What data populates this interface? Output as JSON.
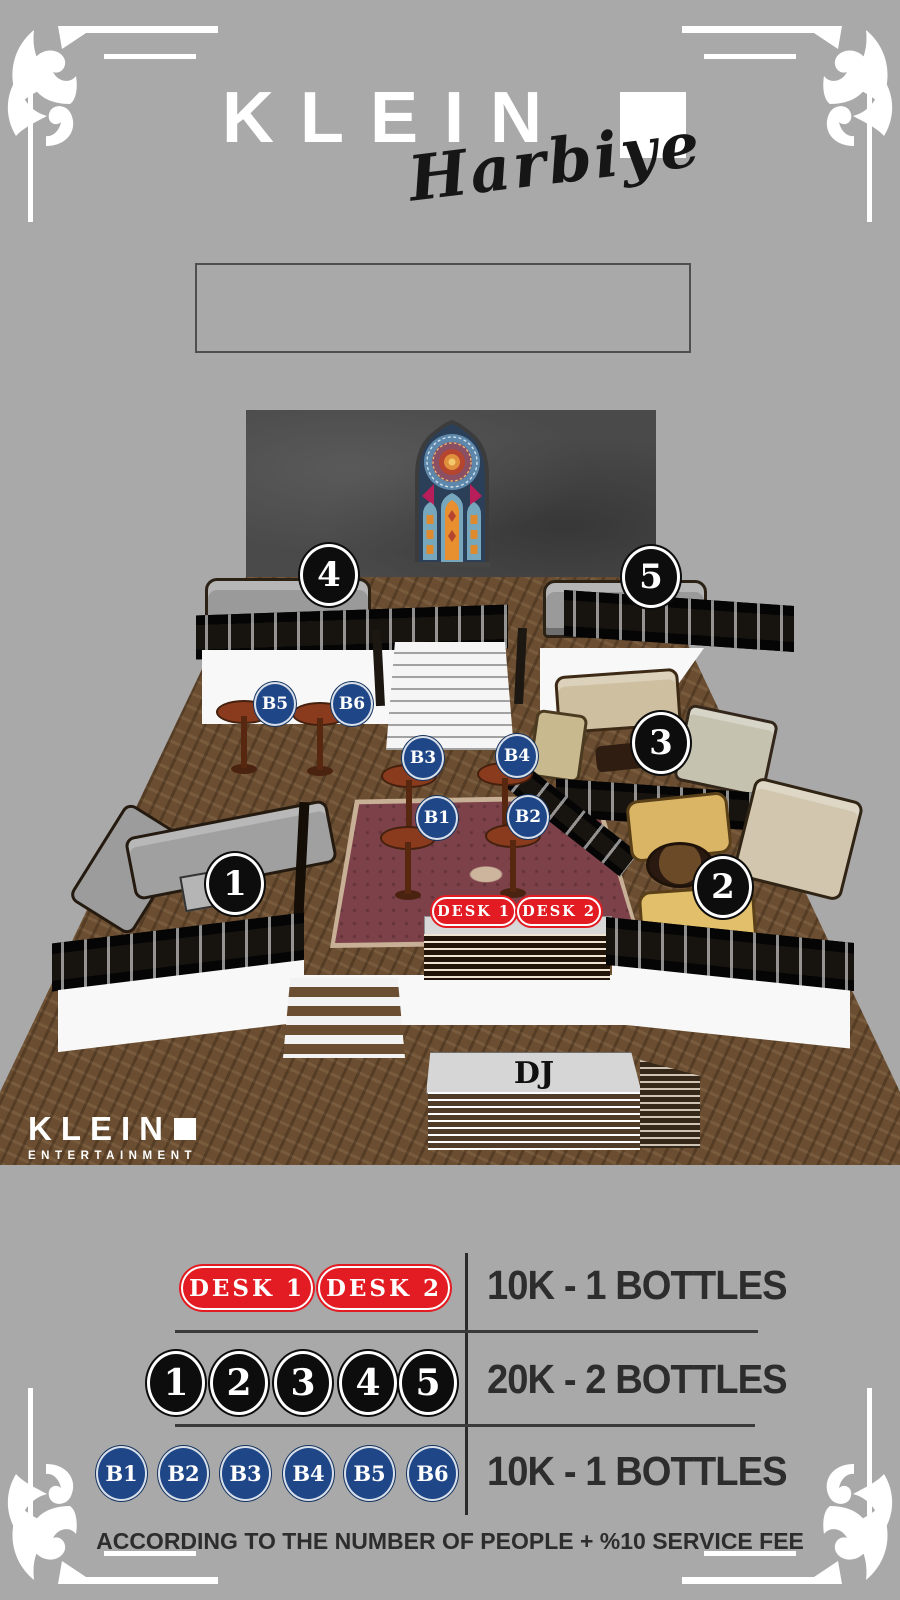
{
  "page": {
    "background": "#a9a9a9"
  },
  "header": {
    "brand": "KLEIN",
    "subtitle": "Harbiye"
  },
  "info_box": {
    "text": ""
  },
  "map": {
    "tables": {
      "t1": "1",
      "t2": "2",
      "t3": "3",
      "t4": "4",
      "t5": "5"
    },
    "bottles": {
      "b1": "B1",
      "b2": "B2",
      "b3": "B3",
      "b4": "B4",
      "b5": "B5",
      "b6": "B6"
    },
    "desks": {
      "d1": "DESK 1",
      "d2": "DESK 2"
    },
    "dj": "DJ",
    "watermark": {
      "brand": "KLEIN",
      "subtitle": "ENTERTAINMENT"
    }
  },
  "legend": {
    "rows": [
      {
        "type": "desk",
        "badges": [
          "DESK 1",
          "DESK 2"
        ],
        "price": "10K - 1 BOTTLES"
      },
      {
        "type": "table",
        "badges": [
          "1",
          "2",
          "3",
          "4",
          "5"
        ],
        "price": "20K - 2 BOTTLES"
      },
      {
        "type": "bottle",
        "badges": [
          "B1",
          "B2",
          "B3",
          "B4",
          "B5",
          "B6"
        ],
        "price": "10K - 1 BOTTLES"
      }
    ],
    "footnote": "ACCORDING TO THE NUMBER OF PEOPLE + %10 SERVICE FEE"
  },
  "colors": {
    "desk_red": "#e31c23",
    "table_black": "#0d0d0d",
    "bottle_blue": "#1f4788",
    "text_dark": "#2d2d2d"
  }
}
